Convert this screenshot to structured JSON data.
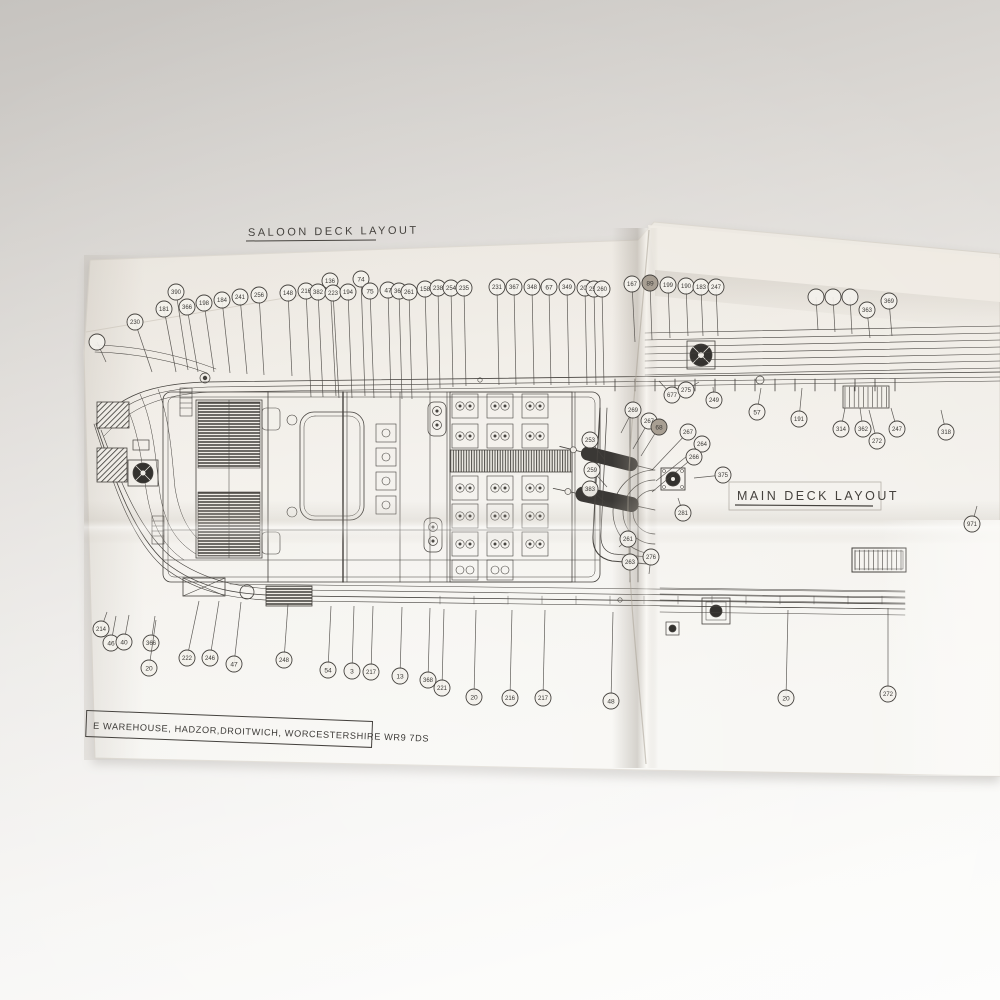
{
  "titles": {
    "saloon_deck": "SALOON DECK LAYOUT",
    "main_deck": "MAIN DECK LAYOUT"
  },
  "title_block": {
    "address": "E WAREHOUSE, HADZOR,DROITWICH, WORCESTERSHIRE WR9 7DS"
  },
  "colors": {
    "paper": "#f0ede7",
    "ink": "#45423e",
    "ink_dark": "#2e2c29",
    "background_top": "#c6c3bf",
    "background_bottom": "#fdfdfc",
    "crease_shadow": "#b3aca2"
  },
  "callouts": [
    {
      "label": "230",
      "x": 135,
      "y": 322,
      "tx": 152,
      "ty": 372
    },
    {
      "label": "181",
      "x": 164,
      "y": 309,
      "tx": 176,
      "ty": 372
    },
    {
      "label": "390",
      "x": 176,
      "y": 292,
      "tx": 188,
      "ty": 370
    },
    {
      "label": "366",
      "x": 187,
      "y": 307,
      "tx": 198,
      "ty": 372
    },
    {
      "label": "198",
      "x": 204,
      "y": 303,
      "tx": 214,
      "ty": 372
    },
    {
      "label": "184",
      "x": 222,
      "y": 300,
      "tx": 230,
      "ty": 373
    },
    {
      "label": "241",
      "x": 240,
      "y": 297,
      "tx": 247,
      "ty": 374
    },
    {
      "label": "256",
      "x": 259,
      "y": 295,
      "tx": 264,
      "ty": 375
    },
    {
      "label": "148",
      "x": 288,
      "y": 293,
      "tx": 292,
      "ty": 376
    },
    {
      "label": "216",
      "x": 306,
      "y": 291,
      "tx": 311,
      "ty": 397
    },
    {
      "label": "382",
      "x": 318,
      "y": 292,
      "tx": 323,
      "ty": 397
    },
    {
      "label": "136",
      "x": 330,
      "y": 281,
      "tx": 336,
      "ty": 396
    },
    {
      "label": "223",
      "x": 333,
      "y": 293,
      "tx": 339,
      "ty": 398
    },
    {
      "label": "194",
      "x": 348,
      "y": 292,
      "tx": 352,
      "ty": 398
    },
    {
      "label": "74",
      "x": 361,
      "y": 279,
      "tx": 365,
      "ty": 396
    },
    {
      "label": "75",
      "x": 370,
      "y": 291,
      "tx": 374,
      "ty": 398
    },
    {
      "label": "47",
      "x": 388,
      "y": 290,
      "tx": 391,
      "ty": 398
    },
    {
      "label": "368",
      "x": 399,
      "y": 291,
      "tx": 402,
      "ty": 399
    },
    {
      "label": "261",
      "x": 409,
      "y": 292,
      "tx": 412,
      "ty": 399
    },
    {
      "label": "158",
      "x": 425,
      "y": 289,
      "tx": 428,
      "ty": 390
    },
    {
      "label": "238",
      "x": 438,
      "y": 288,
      "tx": 440,
      "ty": 388
    },
    {
      "label": "254",
      "x": 451,
      "y": 288,
      "tx": 453,
      "ty": 387
    },
    {
      "label": "235",
      "x": 464,
      "y": 288,
      "tx": 466,
      "ty": 386
    },
    {
      "label": "231",
      "x": 497,
      "y": 287,
      "tx": 499,
      "ty": 385
    },
    {
      "label": "367",
      "x": 514,
      "y": 287,
      "tx": 516,
      "ty": 385
    },
    {
      "label": "348",
      "x": 532,
      "y": 287,
      "tx": 534,
      "ty": 385
    },
    {
      "label": "67",
      "x": 549,
      "y": 287,
      "tx": 551,
      "ty": 385
    },
    {
      "label": "349",
      "x": 567,
      "y": 287,
      "tx": 569,
      "ty": 385
    },
    {
      "label": "204",
      "x": 585,
      "y": 288,
      "tx": 587,
      "ty": 385
    },
    {
      "label": "252",
      "x": 594,
      "y": 289,
      "tx": 596,
      "ty": 385
    },
    {
      "label": "260",
      "x": 602,
      "y": 289,
      "tx": 604,
      "ty": 385
    },
    {
      "label": "167",
      "x": 632,
      "y": 284,
      "tx": 635,
      "ty": 342
    },
    {
      "label": "89",
      "x": 650,
      "y": 283,
      "tx": 652,
      "ty": 340,
      "dark": true
    },
    {
      "label": "199",
      "x": 668,
      "y": 285,
      "tx": 670,
      "ty": 338
    },
    {
      "label": "190",
      "x": 686,
      "y": 286,
      "tx": 688,
      "ty": 336
    },
    {
      "label": "183",
      "x": 701,
      "y": 287,
      "tx": 703,
      "ty": 336
    },
    {
      "label": "247",
      "x": 716,
      "y": 287,
      "tx": 718,
      "ty": 336
    },
    {
      "label": "",
      "x": 816,
      "y": 297,
      "tx": 818,
      "ty": 330
    },
    {
      "label": "",
      "x": 833,
      "y": 297,
      "tx": 835,
      "ty": 332
    },
    {
      "label": "",
      "x": 850,
      "y": 297,
      "tx": 852,
      "ty": 334
    },
    {
      "label": "363",
      "x": 867,
      "y": 310,
      "tx": 870,
      "ty": 338
    },
    {
      "label": "369",
      "x": 889,
      "y": 301,
      "tx": 892,
      "ty": 336
    },
    {
      "label": "",
      "x": 97,
      "y": 342,
      "tx": 106,
      "ty": 362
    },
    {
      "label": "677",
      "x": 672,
      "y": 395,
      "tx": 659,
      "ty": 381
    },
    {
      "label": "275",
      "x": 686,
      "y": 390,
      "tx": 699,
      "ty": 382
    },
    {
      "label": "249",
      "x": 714,
      "y": 400,
      "tx": 713,
      "ty": 387
    },
    {
      "label": "57",
      "x": 757,
      "y": 412,
      "tx": 761,
      "ty": 388
    },
    {
      "label": "191",
      "x": 799,
      "y": 419,
      "tx": 802,
      "ty": 388
    },
    {
      "label": "314",
      "x": 841,
      "y": 429,
      "tx": 845,
      "ty": 408
    },
    {
      "label": "362",
      "x": 863,
      "y": 429,
      "tx": 860,
      "ty": 408
    },
    {
      "label": "272",
      "x": 877,
      "y": 441,
      "tx": 869,
      "ty": 410
    },
    {
      "label": "247",
      "x": 897,
      "y": 429,
      "tx": 891,
      "ty": 408
    },
    {
      "label": "318",
      "x": 946,
      "y": 432,
      "tx": 941,
      "ty": 410
    },
    {
      "label": "269",
      "x": 633,
      "y": 410,
      "tx": 621,
      "ty": 433
    },
    {
      "label": "267",
      "x": 649,
      "y": 421,
      "tx": 633,
      "ty": 449
    },
    {
      "label": "68",
      "x": 659,
      "y": 427,
      "tx": 641,
      "ty": 456,
      "dark": true
    },
    {
      "label": "267",
      "x": 688,
      "y": 432,
      "tx": 652,
      "ty": 470
    },
    {
      "label": "264",
      "x": 702,
      "y": 444,
      "tx": 656,
      "ty": 481
    },
    {
      "label": "266",
      "x": 694,
      "y": 457,
      "tx": 652,
      "ty": 492
    },
    {
      "label": "253",
      "x": 590,
      "y": 440,
      "tx": 605,
      "ty": 460
    },
    {
      "label": "259",
      "x": 592,
      "y": 470,
      "tx": 607,
      "ty": 487
    },
    {
      "label": "383",
      "x": 590,
      "y": 489,
      "tx": 605,
      "ty": 502
    },
    {
      "label": "375",
      "x": 723,
      "y": 475,
      "tx": 694,
      "ty": 478
    },
    {
      "label": "281",
      "x": 683,
      "y": 513,
      "tx": 678,
      "ty": 498
    },
    {
      "label": "261",
      "x": 628,
      "y": 539,
      "tx": 619,
      "ty": 547
    },
    {
      "label": "263",
      "x": 630,
      "y": 562,
      "tx": 622,
      "ty": 566
    },
    {
      "label": "276",
      "x": 651,
      "y": 557,
      "tx": 649,
      "ty": 574
    },
    {
      "label": "971",
      "x": 972,
      "y": 524,
      "tx": 977,
      "ty": 506
    },
    {
      "label": "214",
      "x": 101,
      "y": 629,
      "tx": 107,
      "ty": 612
    },
    {
      "label": "46",
      "x": 111,
      "y": 643,
      "tx": 116,
      "ty": 616
    },
    {
      "label": "40",
      "x": 124,
      "y": 642,
      "tx": 129,
      "ty": 615
    },
    {
      "label": "366",
      "x": 151,
      "y": 643,
      "tx": 155,
      "ty": 616
    },
    {
      "label": "20",
      "x": 149,
      "y": 668,
      "tx": 156,
      "ty": 620
    },
    {
      "label": "222",
      "x": 187,
      "y": 658,
      "tx": 199,
      "ty": 601
    },
    {
      "label": "246",
      "x": 210,
      "y": 658,
      "tx": 219,
      "ty": 601
    },
    {
      "label": "47",
      "x": 234,
      "y": 664,
      "tx": 241,
      "ty": 602
    },
    {
      "label": "248",
      "x": 284,
      "y": 660,
      "tx": 288,
      "ty": 604
    },
    {
      "label": "54",
      "x": 328,
      "y": 670,
      "tx": 331,
      "ty": 606
    },
    {
      "label": "3",
      "x": 352,
      "y": 671,
      "tx": 354,
      "ty": 606
    },
    {
      "label": "217",
      "x": 371,
      "y": 672,
      "tx": 373,
      "ty": 606
    },
    {
      "label": "13",
      "x": 400,
      "y": 676,
      "tx": 402,
      "ty": 607
    },
    {
      "label": "368",
      "x": 428,
      "y": 680,
      "tx": 430,
      "ty": 608
    },
    {
      "label": "221",
      "x": 442,
      "y": 688,
      "tx": 444,
      "ty": 609
    },
    {
      "label": "20",
      "x": 474,
      "y": 697,
      "tx": 476,
      "ty": 610
    },
    {
      "label": "216",
      "x": 510,
      "y": 698,
      "tx": 512,
      "ty": 610
    },
    {
      "label": "217",
      "x": 543,
      "y": 698,
      "tx": 545,
      "ty": 610
    },
    {
      "label": "48",
      "x": 611,
      "y": 701,
      "tx": 613,
      "ty": 612
    },
    {
      "label": "20",
      "x": 786,
      "y": 698,
      "tx": 788,
      "ty": 610
    },
    {
      "label": "272",
      "x": 888,
      "y": 694,
      "tx": 888,
      "ty": 608
    }
  ]
}
